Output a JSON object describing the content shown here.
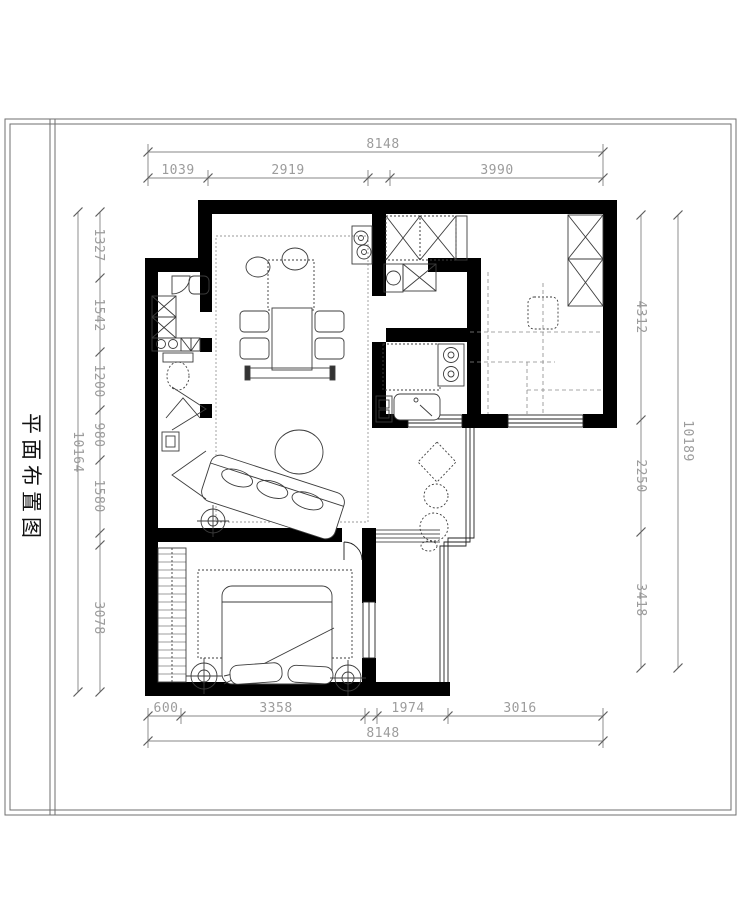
{
  "sheet": {
    "title": "平面布置图"
  },
  "colors": {
    "wall": "#000000",
    "window": "#222222",
    "furniture_line": "#3c3c3c",
    "dashed_line": "#8a8a8a",
    "dim_line": "#5f5f5f",
    "dim_text": "#9c9c9c",
    "frame": "#6f6f6f",
    "background": "#ffffff"
  },
  "dimensions": {
    "top": {
      "total": "8148",
      "segments": [
        "1039",
        "2919",
        "3990"
      ]
    },
    "bottom": {
      "total": "8148",
      "segments": [
        "600",
        "3358",
        "1974",
        "3016"
      ]
    },
    "left": {
      "total": "10164",
      "segments": [
        "1327",
        "1542",
        "1200",
        "980",
        "1580",
        "3078"
      ]
    },
    "right": {
      "total": "10189",
      "segments": [
        "4312",
        "2250",
        "3418"
      ]
    }
  }
}
